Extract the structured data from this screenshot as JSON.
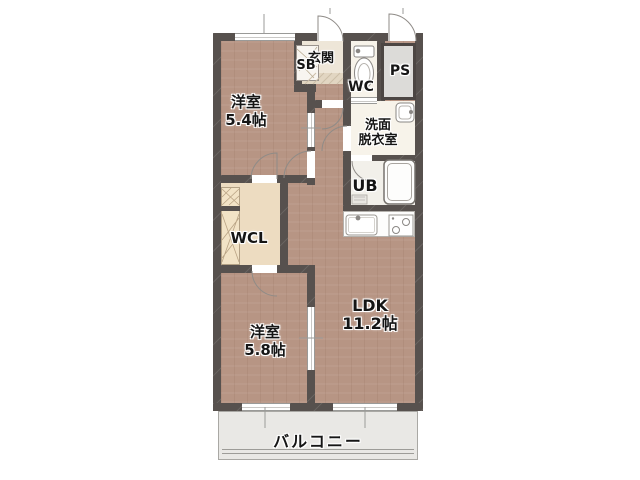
{
  "rooms": {
    "bedroom1": {
      "name": "洋室",
      "size": "5.4帖"
    },
    "bedroom2": {
      "name": "洋室",
      "size": "5.8帖"
    },
    "ldk": {
      "name": "LDK",
      "size": "11.2帖"
    },
    "wcl": {
      "name": "WCL"
    },
    "ub": {
      "name": "UB"
    },
    "wc": {
      "name": "WC"
    },
    "ps": {
      "name": "PS"
    },
    "sb": {
      "name": "SB"
    },
    "entrance": {
      "name": "玄関"
    },
    "washroom": {
      "line1": "洗面",
      "line2": "脱衣室"
    },
    "balcony": {
      "name": "バルコニー"
    }
  },
  "colors": {
    "wall": "#57514e",
    "wood_floor": "#b79584",
    "wcl_floor": "#eddcc1",
    "wet_floor": "#f7f3ea",
    "ub_floor": "#f2f0ea",
    "entry_tile": "#eee6d8",
    "ps_fill": "#dcdbd8",
    "balcony_fill": "#e9e8e5",
    "fixture_stroke": "#8a8784",
    "text": "#151515"
  }
}
